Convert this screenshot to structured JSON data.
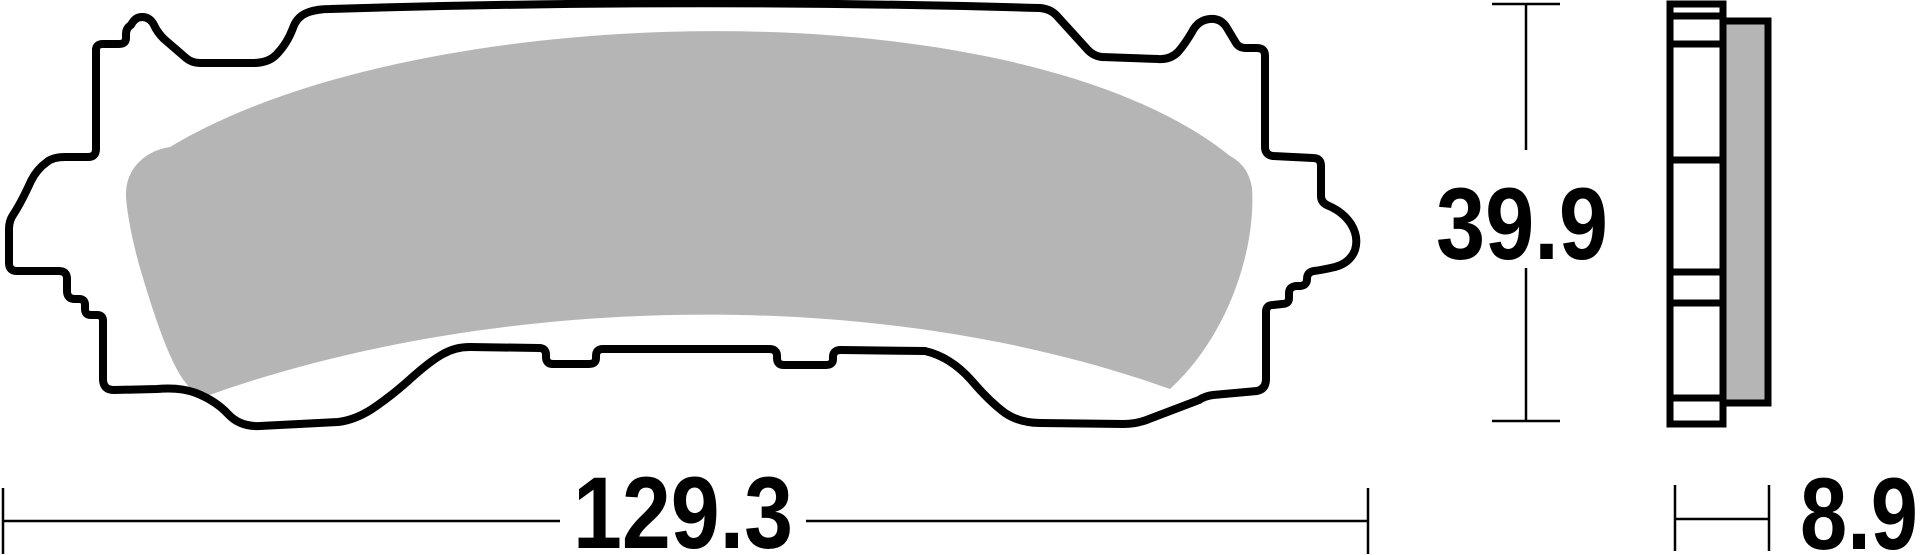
{
  "drawing": {
    "dimensions": {
      "width_label": "129.3",
      "height_label": "39.9",
      "thickness_label": "8.9"
    },
    "colors": {
      "ink": "#000000",
      "friction_material": "#b5b5b5",
      "background": "#ffffff"
    }
  }
}
